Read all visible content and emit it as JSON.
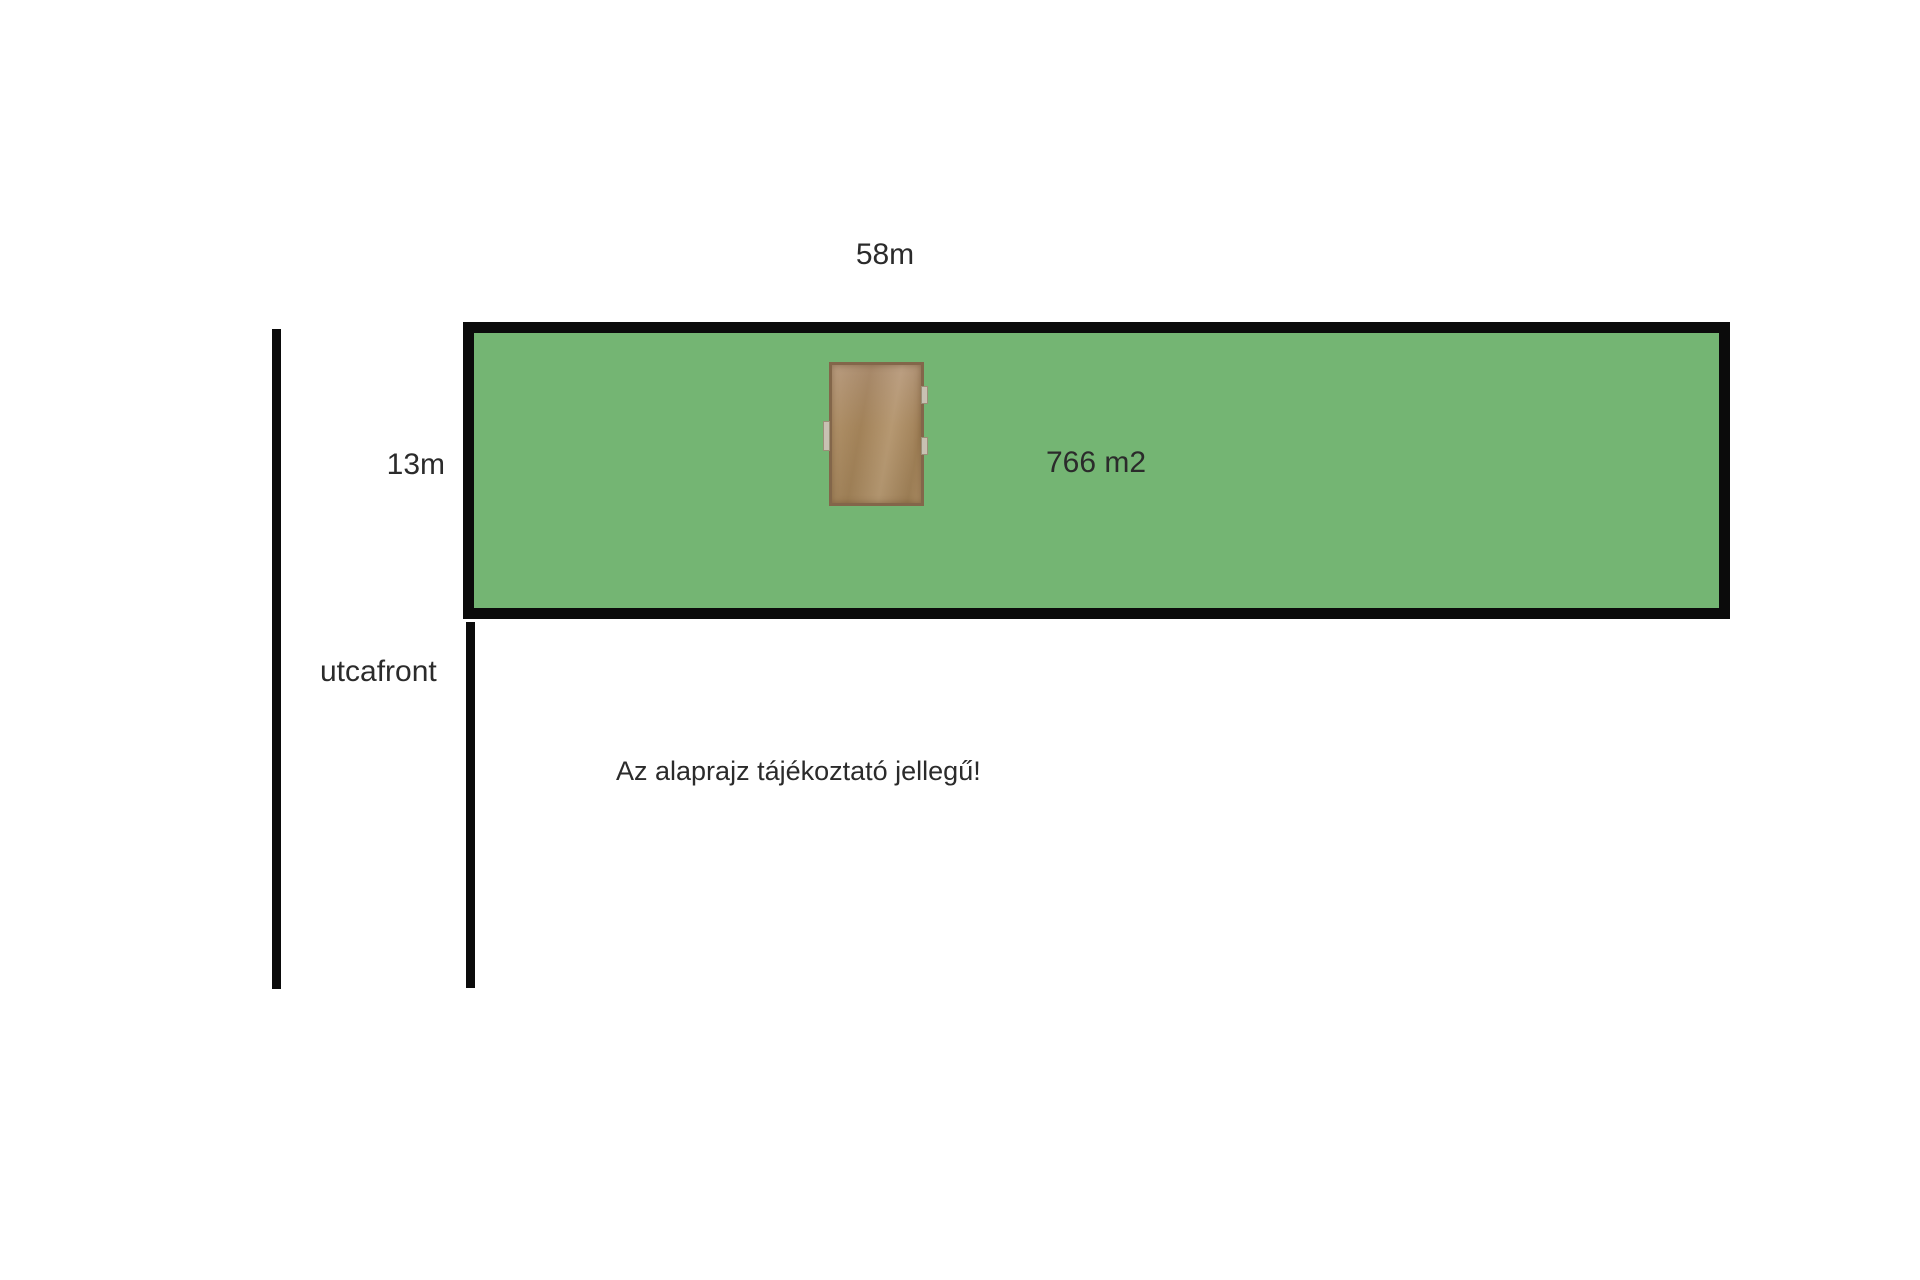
{
  "plan": {
    "dimensions": {
      "top": "58m",
      "side": "13m"
    },
    "area_label": "766 m2",
    "street_label": "utcafront",
    "disclaimer": "Az alaprajz tájékoztató jellegű!",
    "colors": {
      "background": "#ffffff",
      "plot_fill": "#74b573",
      "outline": "#0b0b0b",
      "text": "#2b2b2b",
      "building_fill": "#ac8a5e",
      "building_frame": "#83664a",
      "building_tab": "#c8c1b2"
    }
  }
}
